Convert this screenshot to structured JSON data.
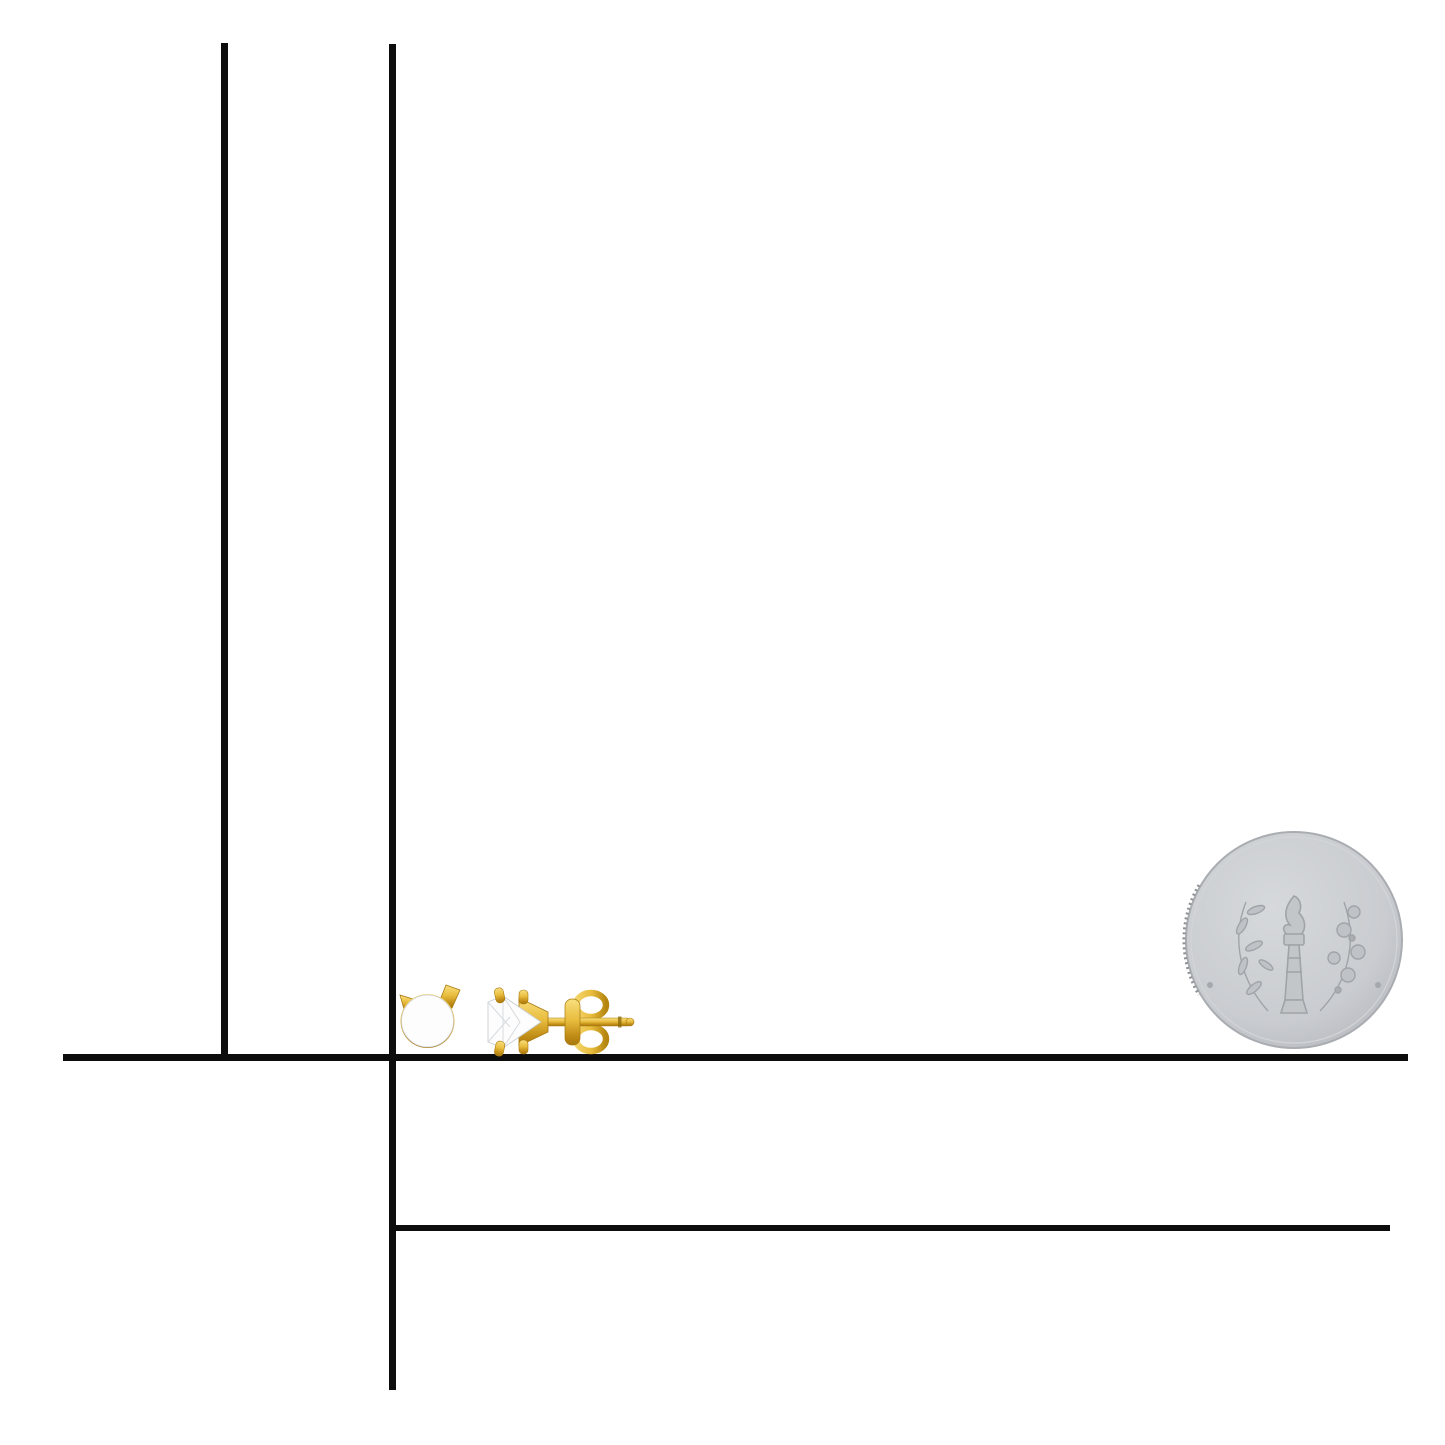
{
  "scale_note": "10 mm = 1 cm",
  "colors": {
    "ink": "#0d0d0d",
    "gold": "#e9bd3e",
    "gold_light": "#f8df7e",
    "gold_dark": "#a9790e",
    "diamond_white": "#fdfdfe",
    "diamond_facet_light": "#f2f4f6",
    "diamond_facet_dark": "#e3e7ea",
    "coin_face": "#c9ccd0",
    "coin_edge": "#a9adb1",
    "coin_emboss": "#9aa0a5"
  },
  "rulers": {
    "vertical_inches": {
      "unit_label": "Inches",
      "numbers": [
        "1",
        "2"
      ],
      "ticks_per_inch": 16,
      "visible_range_inches": 2.94
    },
    "vertical_mm": {
      "unit_label": "mm",
      "tick_labels": [
        "10mm",
        "20mm",
        "30mm",
        "40mm",
        "50mm",
        "60mm",
        "70mm"
      ],
      "range_mm": 75
    },
    "horizontal_mm": {
      "unit_label": "mm",
      "tick_labels": [
        "10mm",
        "20mm",
        "30mm",
        "40mm",
        "50mm",
        "60mm",
        "70mm"
      ],
      "range_mm": 75
    },
    "horizontal_inches": {
      "unit_label": "Inches",
      "numbers": [
        "1",
        "2"
      ],
      "ticks_per_inch": 16,
      "visible_range_inches": 2.94
    }
  },
  "coin": {
    "name": "US dime reverse",
    "top_text": "UNITED STATES OF AMERICA",
    "middle_text": "E PLURIBUS UNUM",
    "bottom_text": "ONE DIME"
  },
  "products": {
    "left_item": "diamond stud front view",
    "right_item": "diamond stud side view"
  }
}
